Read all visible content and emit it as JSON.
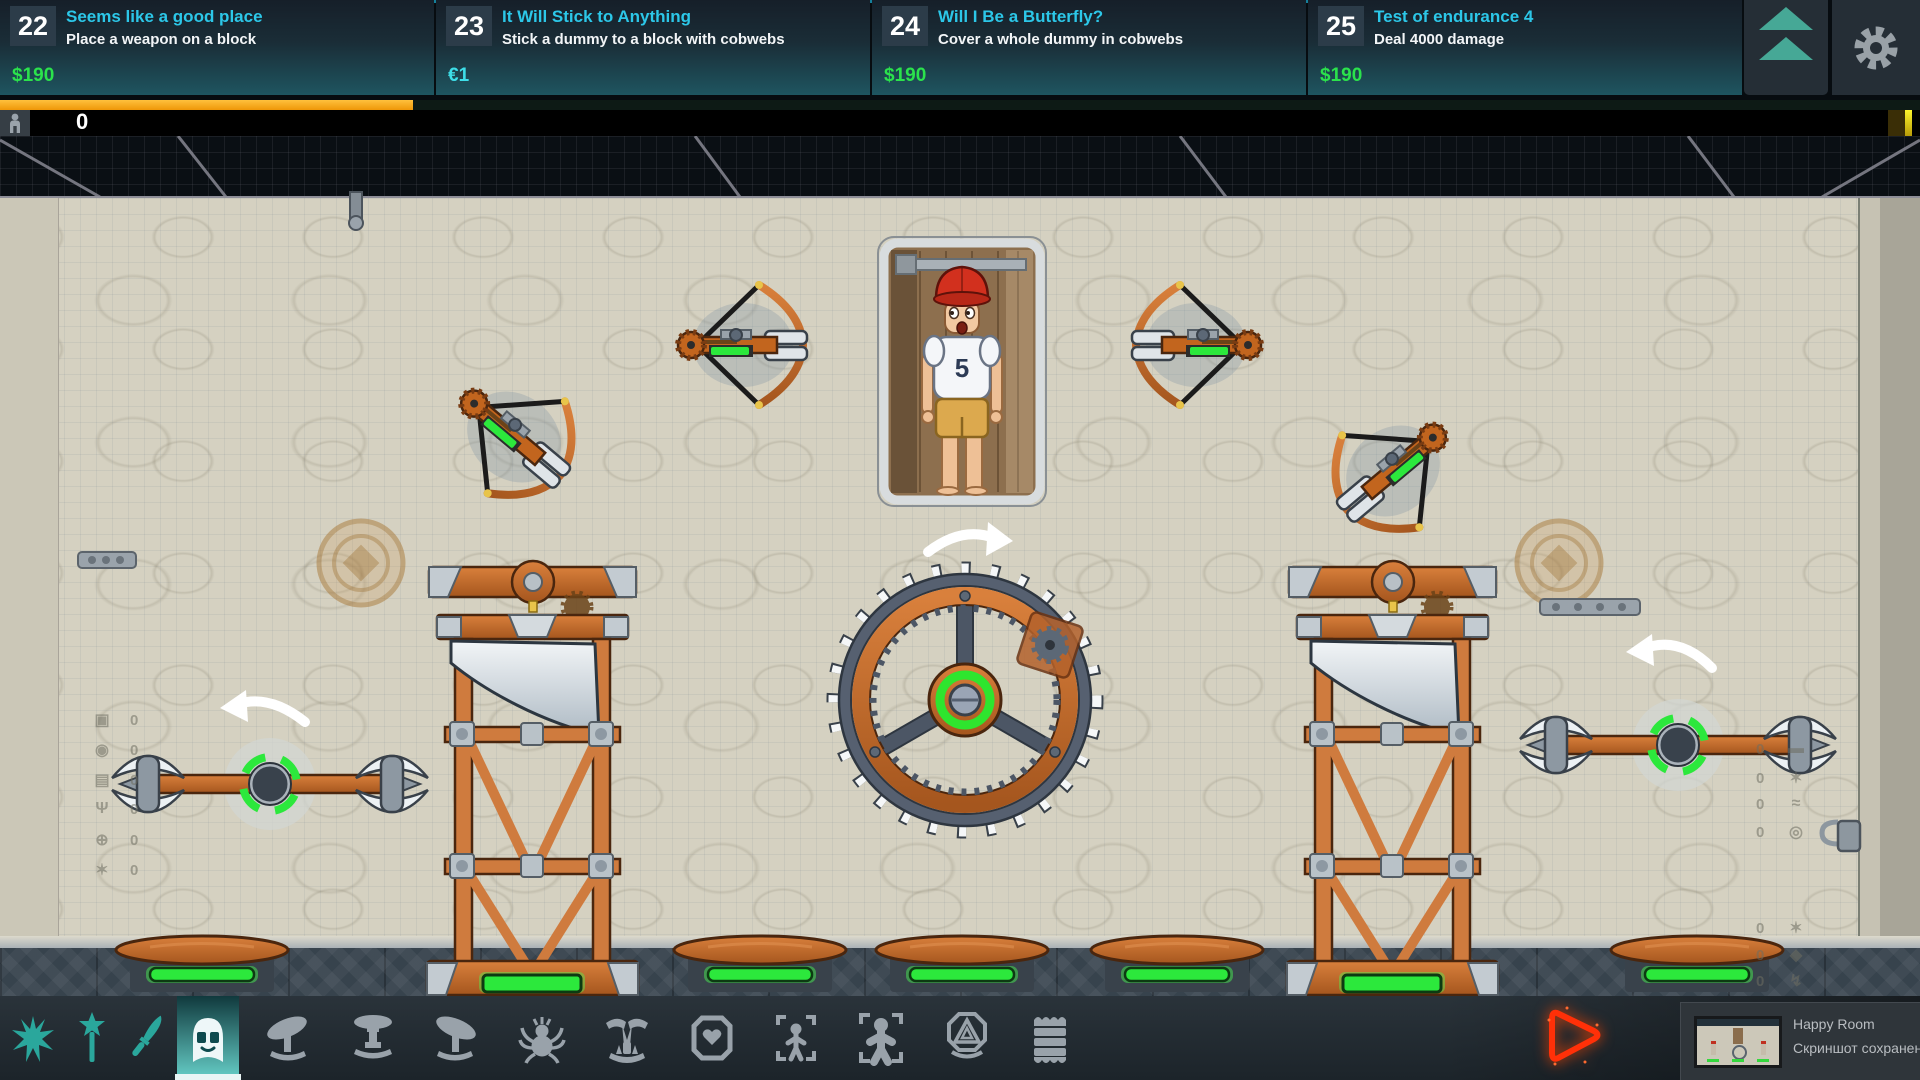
{
  "header": {
    "quest_cards": [
      {
        "number": "22",
        "title": "Seems like a good place",
        "description": "Place a weapon on a block",
        "reward": "$190"
      },
      {
        "number": "23",
        "title": "It Will Stick to Anything",
        "description": "Stick a dummy to a block with cobwebs",
        "reward": "€1"
      },
      {
        "number": "24",
        "title": "Will I Be a Butterfly?",
        "description": "Cover a whole dummy in cobwebs",
        "reward": "$190"
      },
      {
        "number": "25",
        "title": "Test of endurance 4",
        "description": "Deal 4000 damage",
        "reward": "$190"
      }
    ],
    "quest_toggle_icon": "double-up-arrow",
    "settings_icon": "gear",
    "progress_fill_ratio": 0.215,
    "progress_color": "#f6a01b"
  },
  "damage_bar": {
    "player_icon": "person",
    "value": "0"
  },
  "scene": {
    "dummy_number": "5",
    "left_counters": [
      {
        "icon": "block",
        "glyph": "▣",
        "count": "0"
      },
      {
        "icon": "saw-disc",
        "glyph": "◉",
        "count": "0"
      },
      {
        "icon": "press",
        "glyph": "▤",
        "count": "0"
      },
      {
        "icon": "trident",
        "glyph": "Ψ",
        "count": "0"
      },
      {
        "icon": "crossbow",
        "glyph": "⊕",
        "count": "0"
      },
      {
        "icon": "mine",
        "glyph": "✶",
        "count": "0"
      }
    ],
    "right_counters": [
      {
        "icon": "needles",
        "glyph": "▬",
        "count": "0"
      },
      {
        "icon": "spike-mine",
        "glyph": "✶",
        "count": "0"
      },
      {
        "icon": "whip",
        "glyph": "≈",
        "count": "0"
      },
      {
        "icon": "ship-wheel",
        "glyph": "◎",
        "count": "0"
      },
      {
        "icon": "burr",
        "glyph": "✶",
        "count": "0"
      },
      {
        "icon": "bug",
        "glyph": "◆",
        "count": "0"
      },
      {
        "icon": "torch",
        "glyph": "↯",
        "count": "0"
      },
      {
        "icon": "crate",
        "glyph": "▦",
        "count": "0"
      }
    ]
  },
  "toolbar": {
    "items": [
      {
        "name": "spikes",
        "selected": false
      },
      {
        "name": "star-wand",
        "selected": false
      },
      {
        "name": "knife",
        "selected": false
      },
      {
        "name": "helmet",
        "selected": true
      },
      {
        "name": "saw-launcher-left",
        "selected": false
      },
      {
        "name": "press-table",
        "selected": false
      },
      {
        "name": "saw-launcher-right",
        "selected": false
      },
      {
        "name": "spider",
        "selected": false
      },
      {
        "name": "claw-trap",
        "selected": false
      },
      {
        "name": "heart-crate",
        "selected": false
      },
      {
        "name": "dummy-small",
        "selected": false
      },
      {
        "name": "dummy-large",
        "selected": false
      },
      {
        "name": "rune-emblem",
        "selected": false
      },
      {
        "name": "coil-stack",
        "selected": false
      }
    ]
  },
  "footer": {
    "play_icon": "play-triangle",
    "notification": {
      "app_name": "Happy Room",
      "message": "Скриншот сохранен"
    }
  },
  "colors": {
    "title_cyan": "#2cc7e8",
    "reward_green": "#2be24c",
    "reward_cyan": "#3edee8",
    "progress_orange": "#f6a01b",
    "pad_green": "#2ce83c",
    "wood_orange": "#c2651e",
    "play_red": "#ff3008",
    "teal_icon": "#2aa79c"
  }
}
